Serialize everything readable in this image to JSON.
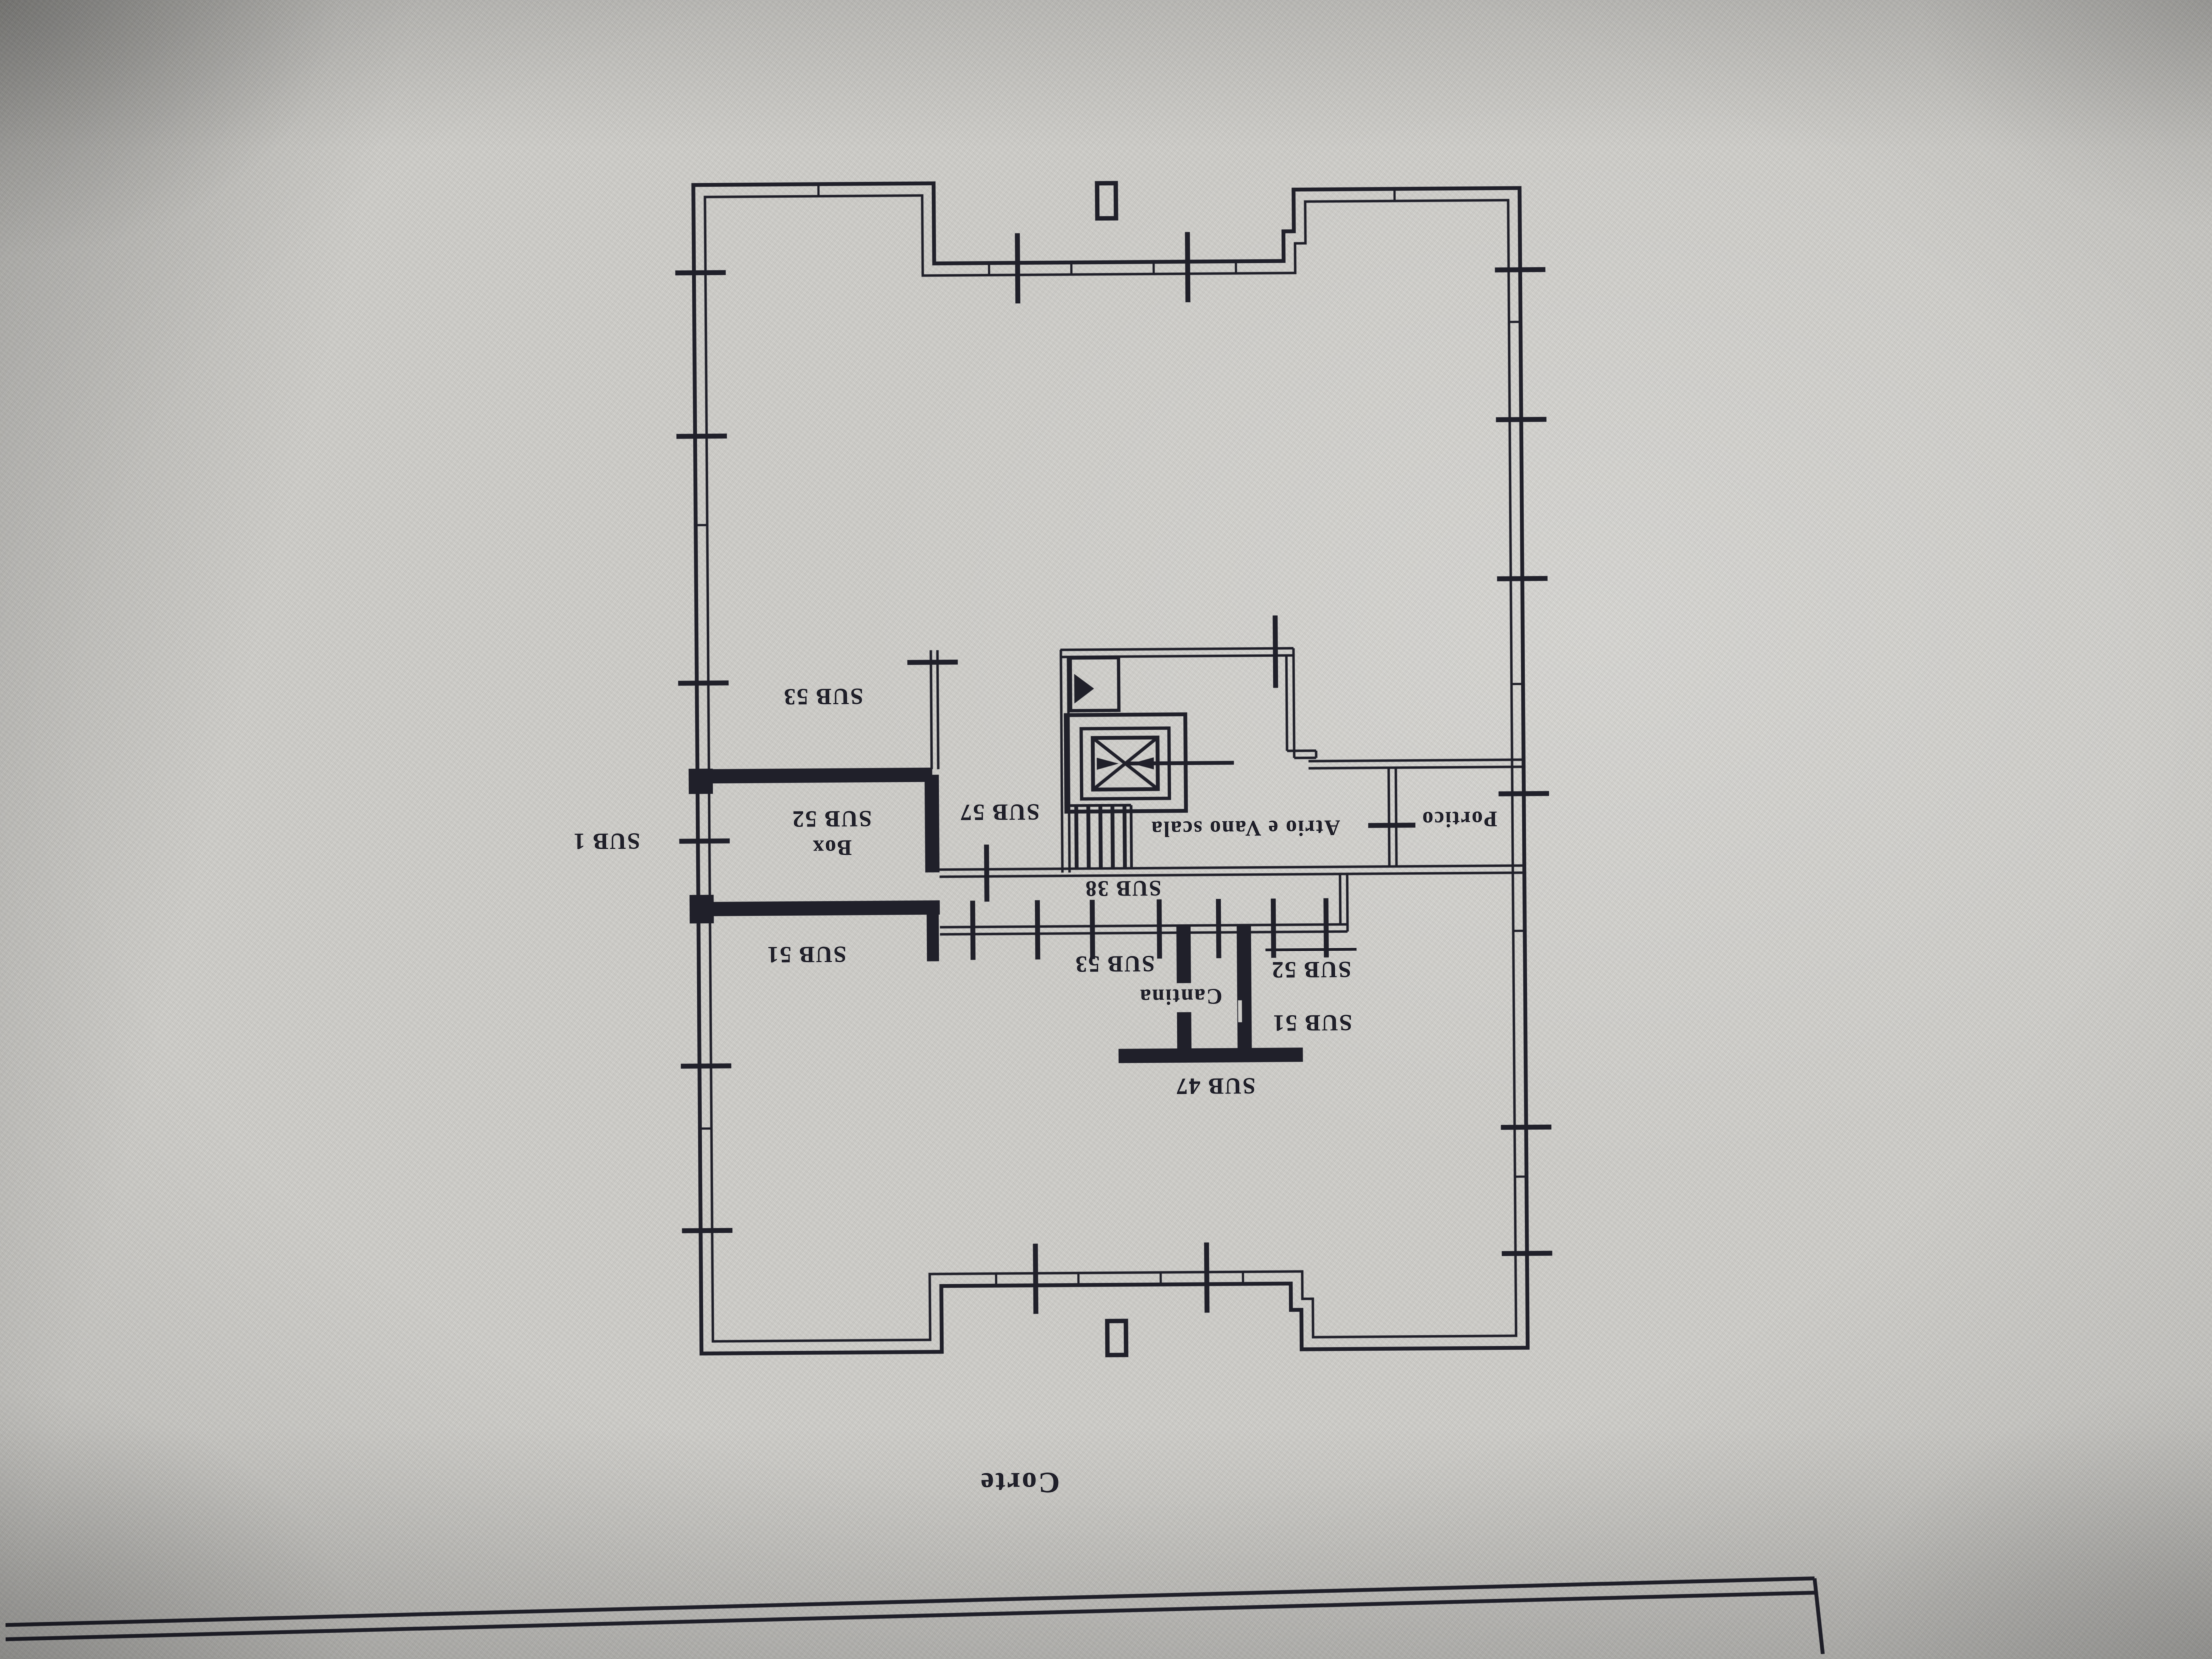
{
  "plan": {
    "ink_color": "#20202a",
    "paper_color": "#cdccc8",
    "labels": {
      "sub53_top_left": "SUB 53",
      "sub1_outside": "SUB 1",
      "sub52_box_room": "SUB 52",
      "box_room": "Box",
      "sub51_left": "SUB 51",
      "sub57": "SUB 57",
      "atrio_vano_scala": "Atrio e Vano scala",
      "portico": "Portico",
      "sub38_corridor": "SUB 38",
      "sub53_center": "SUB 53",
      "sub52_center": "SUB 52",
      "cantina": "Cantina",
      "sub51_center": "SUB 51",
      "sub47": "SUB 47",
      "corte": "Corte"
    }
  }
}
